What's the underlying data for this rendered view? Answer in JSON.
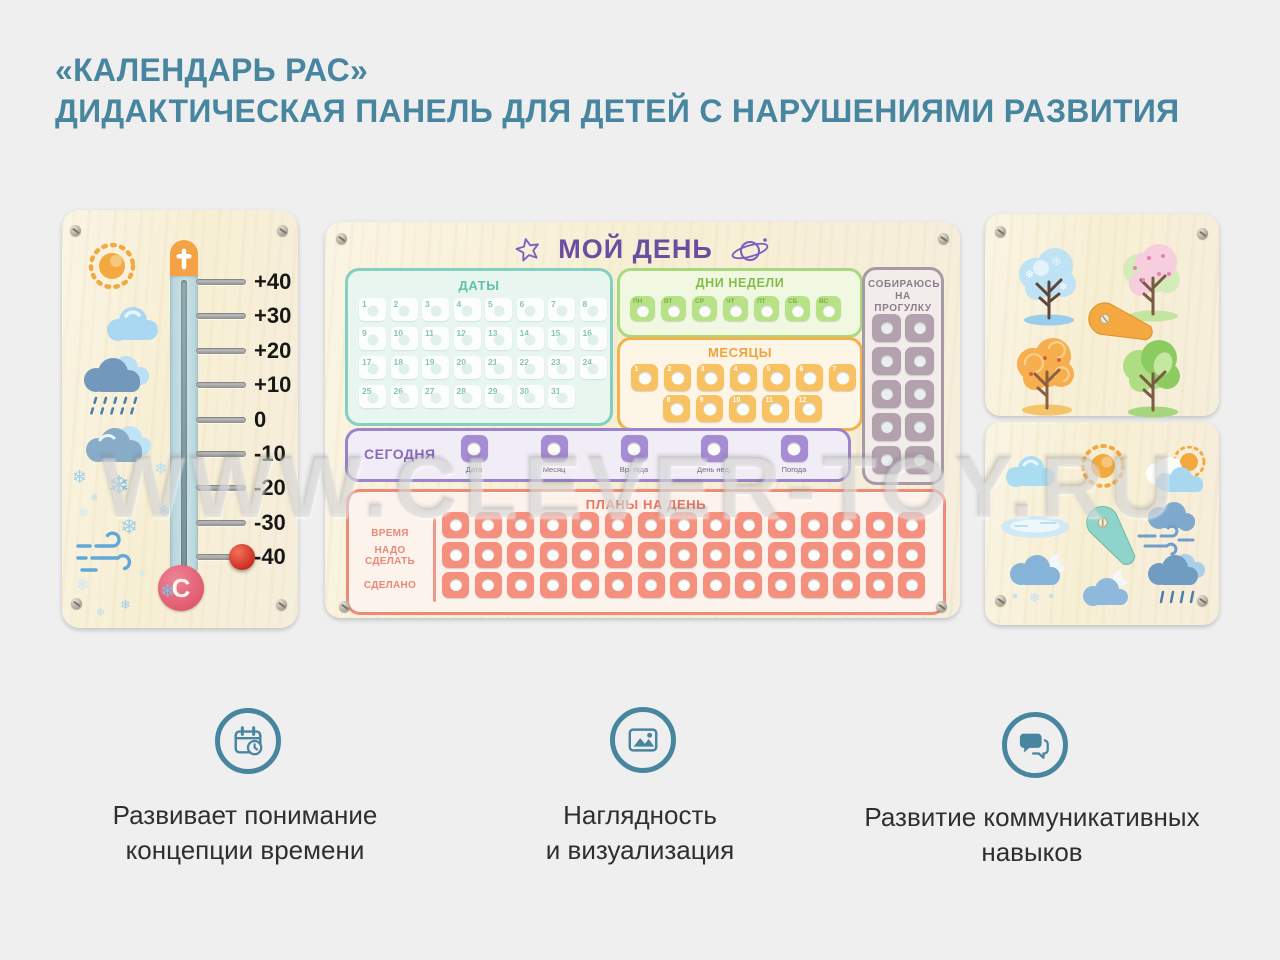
{
  "title": {
    "line1": "«КАЛЕНДАРЬ РАС»",
    "line2": "ДИДАКТИЧЕСКАЯ ПАНЕЛЬ ДЛЯ ДЕТЕЙ С НАРУШЕНИЯМИ РАЗВИТИЯ"
  },
  "watermark": "WWW.CLEVER-TOY.RU",
  "colors": {
    "accent": "#4886a0",
    "board_purple": "#6a4fa0",
    "dates_teal": "#5fc0ae",
    "week_green": "#84bd4d",
    "months_orange": "#f0a23c",
    "walk_mauve": "#8b7d89",
    "today_purple": "#8a68bc",
    "plans_salmon": "#ec7360",
    "cap_orange": "#f3a345",
    "bulb_pink": "#e5697a",
    "knob_red": "#d63a28",
    "text_dark": "#2f2f2f"
  },
  "thermometer_panel": {
    "scale_labels": [
      "+40",
      "+30",
      "+20",
      "+10",
      "0",
      "-10",
      "-20",
      "-30",
      "-40"
    ],
    "knob_value": "-40",
    "bulb_letter": "C",
    "weather_icons": [
      "sun-icon",
      "cloud-icon",
      "rain-cloud-icon",
      "snow-cloud-icon",
      "wind-icon"
    ],
    "snowflake_glyph": "❄"
  },
  "main_board": {
    "title": "МОЙ ДЕНЬ",
    "header_icons": [
      "star-icon",
      "planet-icon"
    ],
    "dates": {
      "label": "ДАТЫ",
      "numbers": [
        "1",
        "2",
        "3",
        "4",
        "5",
        "6",
        "7",
        "8",
        "9",
        "10",
        "11",
        "12",
        "13",
        "14",
        "15",
        "16",
        "17",
        "18",
        "19",
        "20",
        "21",
        "22",
        "23",
        "24",
        "25",
        "26",
        "27",
        "28",
        "29",
        "30",
        "31"
      ]
    },
    "weekdays": {
      "label": "ДНИ НЕДЕЛИ",
      "days": [
        "ПН",
        "ВТ",
        "СР",
        "ЧТ",
        "ПТ",
        "СБ",
        "ВС"
      ]
    },
    "months": {
      "label": "МЕСЯЦЫ",
      "numbers": [
        "1",
        "2",
        "3",
        "4",
        "5",
        "6",
        "7",
        "8",
        "9",
        "10",
        "11",
        "12"
      ]
    },
    "walk": {
      "label": "СОБИРАЮСЬ НА ПРОГУЛКУ",
      "slots": 10
    },
    "today": {
      "label": "СЕГОДНЯ",
      "fields": [
        "Дата",
        "Месяц",
        "Вр. года",
        "День нед.",
        "Погода"
      ]
    },
    "plans": {
      "label": "ПЛАНЫ НА ДЕНЬ",
      "row_labels": [
        "ВРЕМЯ",
        "НАДО СДЕЛАТЬ",
        "СДЕЛАНО"
      ],
      "columns": 15
    }
  },
  "seasons_panel": {
    "items": [
      "winter-tree",
      "spring-tree",
      "autumn-tree",
      "summer-tree"
    ],
    "spinner": "arrow-spinner"
  },
  "weather_panel": {
    "items": [
      "cloud-icon",
      "sun-icon",
      "sun-behind-cloud-icon",
      "puddle-icon",
      "windy-cloud-icon",
      "snow-night-cloud-icon",
      "night-cloud-icon",
      "rain-cloud-icon"
    ],
    "spinner": "arrow-spinner"
  },
  "features": [
    {
      "icon": "calendar-clock-icon",
      "line1": "Развивает понимание",
      "line2": "концепции времени"
    },
    {
      "icon": "picture-icon",
      "line1": "Наглядность",
      "line2": "и визуализация"
    },
    {
      "icon": "chat-bubbles-icon",
      "line1": "Развитие коммуникативных",
      "line2": "навыков"
    }
  ]
}
